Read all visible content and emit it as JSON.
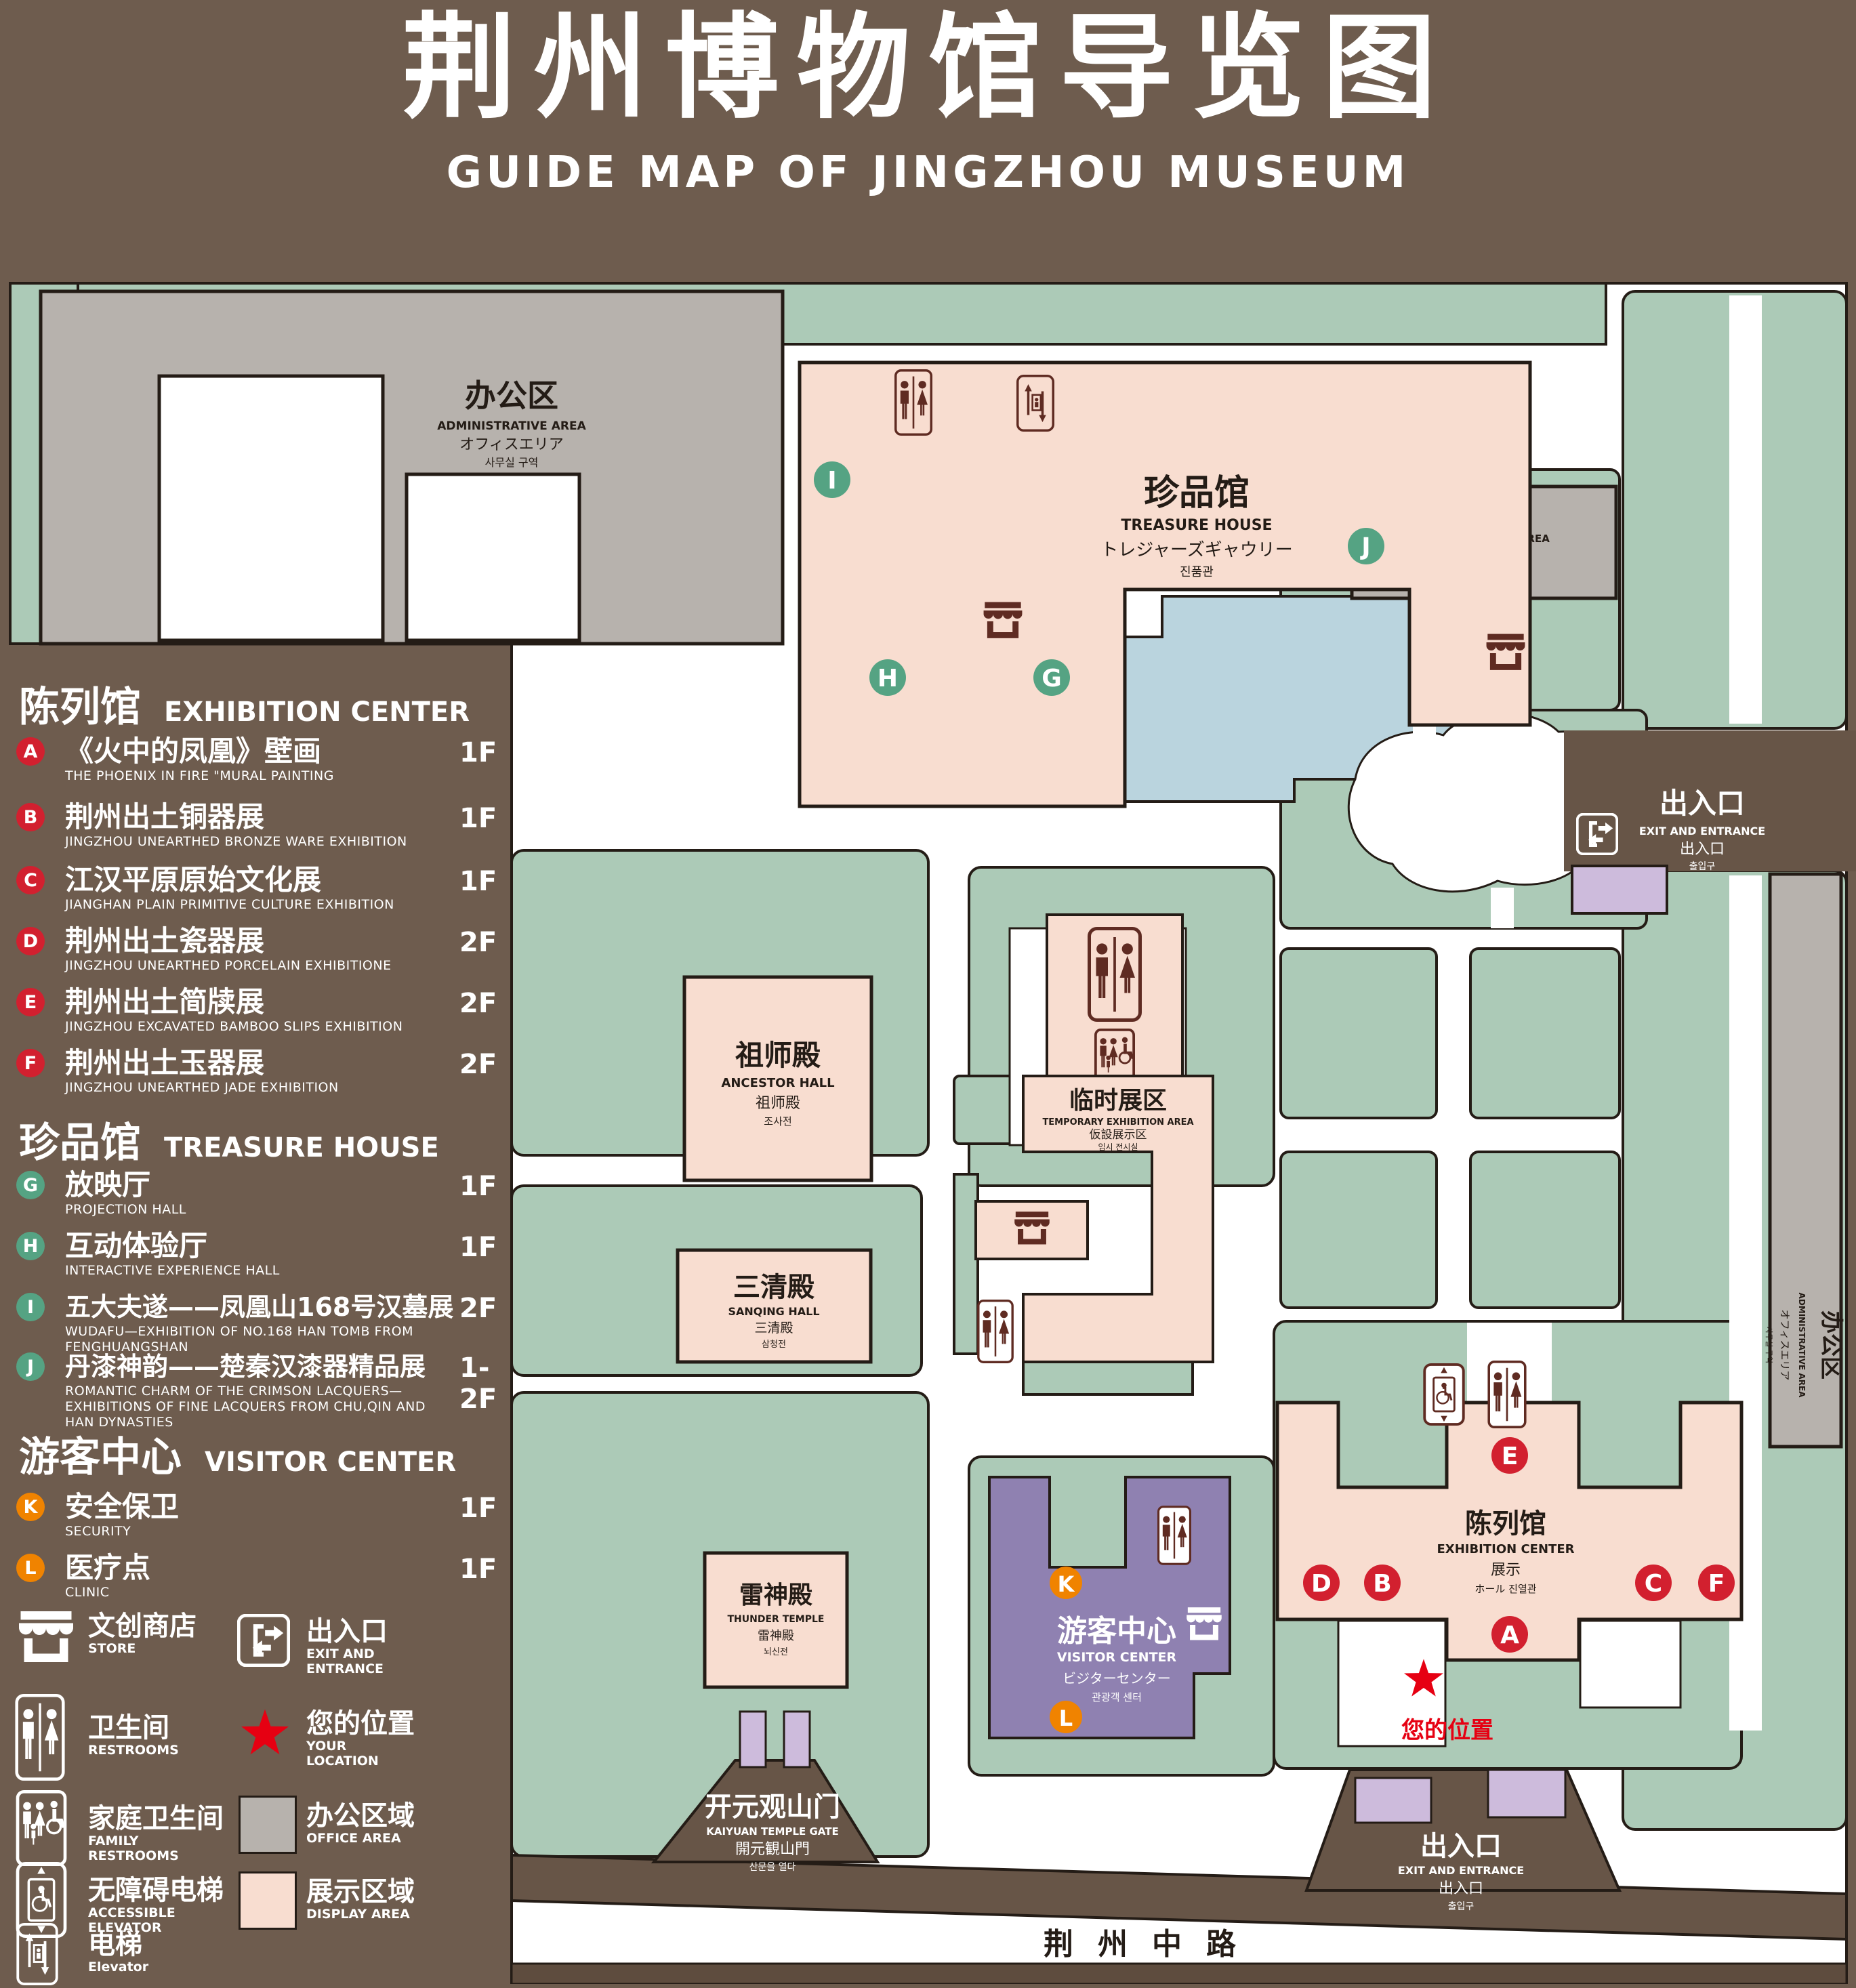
{
  "title": {
    "cn": "荆州博物馆导览图",
    "en": "GUIDE MAP OF JINGZHOU MUSEUM"
  },
  "colors": {
    "background": "#6e5c4e",
    "green_area": "#accab7",
    "display_area": "#f8ddd0",
    "office_area": "#b7b2ad",
    "pond": "#bad4de",
    "visitor_center": "#8f81b1",
    "gate_purple": "#cdbbdc",
    "badge_red": "#d2202f",
    "badge_green": "#55a383",
    "badge_orange": "#f08300",
    "star_red": "#e60012",
    "icon_maroon": "#5f2b22"
  },
  "legend": {
    "sections": [
      {
        "cn": "陈列馆",
        "en": "EXHIBITION CENTER",
        "items": [
          {
            "letter": "A",
            "cn": "《火中的凤凰》壁画",
            "en": "THE PHOENIX IN FIRE \"MURAL PAINTING",
            "floor": "1F"
          },
          {
            "letter": "B",
            "cn": "荆州出土铜器展",
            "en": "JINGZHOU UNEARTHED BRONZE WARE EXHIBITION",
            "floor": "1F"
          },
          {
            "letter": "C",
            "cn": "江汉平原原始文化展",
            "en": "JIANGHAN PLAIN PRIMITIVE CULTURE EXHIBITION",
            "floor": "1F"
          },
          {
            "letter": "D",
            "cn": "荆州出土瓷器展",
            "en": "JINGZHOU UNEARTHED PORCELAIN EXHIBITIONE",
            "floor": "2F"
          },
          {
            "letter": "E",
            "cn": "荆州出土简牍展",
            "en": "JINGZHOU EXCAVATED BAMBOO SLIPS EXHIBITION",
            "floor": "2F"
          },
          {
            "letter": "F",
            "cn": "荆州出土玉器展",
            "en": "JINGZHOU UNEARTHED JADE EXHIBITION",
            "floor": "2F"
          }
        ]
      },
      {
        "cn": "珍品馆",
        "en": "TREASURE HOUSE",
        "items": [
          {
            "letter": "G",
            "cn": "放映厅",
            "en": "PROJECTION HALL",
            "floor": "1F"
          },
          {
            "letter": "H",
            "cn": "互动体验厅",
            "en": "INTERACTIVE EXPERIENCE HALL",
            "floor": "1F"
          },
          {
            "letter": "I",
            "cn": "五大夫遂——凤凰山168号汉墓展",
            "en": "WUDAFU—EXHIBITION OF NO.168 HAN TOMB FROM FENGHUANGSHAN",
            "floor": "2F"
          },
          {
            "letter": "J",
            "cn": "丹漆神韵——楚秦汉漆器精品展",
            "en": "ROMANTIC CHARM OF THE CRIMSON LACQUERS—EXHIBITIONS OF FINE LACQUERS FROM CHU,QIN AND HAN DYNASTIES",
            "floor": "1-2F"
          }
        ]
      },
      {
        "cn": "游客中心",
        "en": "VISITOR CENTER",
        "items": [
          {
            "letter": "K",
            "cn": "安全保卫",
            "en": "SECURITY",
            "floor": "1F"
          },
          {
            "letter": "L",
            "cn": "医疗点",
            "en": "CLINIC",
            "floor": "1F"
          }
        ]
      }
    ],
    "symbols": {
      "store": {
        "cn": "文创商店",
        "en": "STORE"
      },
      "restrooms": {
        "cn": "卫生间",
        "en": "RESTROOMS"
      },
      "family_restrooms": {
        "cn": "家庭卫生间",
        "en": "FAMILY RESTROOMS"
      },
      "accessible_elevator": {
        "cn": "无障碍电梯",
        "en": "ACCESSIBLE ELEVATOR"
      },
      "elevator": {
        "cn": "电梯",
        "en": "Elevator"
      },
      "exit": {
        "cn": "出入口",
        "en": "EXIT AND ENTRANCE"
      },
      "your_location": {
        "cn": "您的位置",
        "en": "YOUR LOCATION"
      },
      "office_area": {
        "cn": "办公区域",
        "en": "OFFICE AREA"
      },
      "display_area": {
        "cn": "展示区域",
        "en": "DISPLAY AREA"
      }
    }
  },
  "map": {
    "treasure_house": {
      "cn": "珍品馆",
      "en": "TREASURE HOUSE",
      "l3": "トレジャーズギャウリー",
      "l4": "진품관"
    },
    "admin_area": {
      "cn": "办公区",
      "en": "ADMINISTRATIVE AREA",
      "l3": "オフィスエリア",
      "l4": "사무실 구역"
    },
    "ancestor_hall": {
      "cn": "祖师殿",
      "en": "ANCESTOR HALL",
      "l3": "祖师殿",
      "l4": "조사전"
    },
    "sanqing_hall": {
      "cn": "三清殿",
      "en": "SANQING HALL",
      "l3": "三清殿",
      "l4": "삼청전"
    },
    "thunder_temple": {
      "cn": "雷神殿",
      "en": "THUNDER TEMPLE",
      "l3": "雷神殿",
      "l4": "뇌신전"
    },
    "temporary_exhibition": {
      "cn": "临时展区",
      "en": "TEMPORARY EXHIBITION AREA",
      "l3": "仮設展示区",
      "l4": "임시 전시실"
    },
    "visitor_center": {
      "cn": "游客中心",
      "en": "VISITOR CENTER",
      "l3": "ビジターセンター",
      "l4": "관광객 센터"
    },
    "exhibition_center": {
      "cn": "陈列馆",
      "en": "EXHIBITION CENTER",
      "l3": "展示",
      "l4": "ホール 진열관"
    },
    "gate_south": {
      "cn": "开元观山门",
      "en": "KAIYUAN TEMPLE GATE",
      "l3": "開元観山門",
      "l4": "산문을 열다"
    },
    "exit_gate": {
      "cn": "出入口",
      "en": "EXIT AND ENTRANCE",
      "l3": "出入口",
      "l4": "출입구"
    },
    "road": "荆州中路",
    "your_location": "您的位置",
    "badges": {
      "red": [
        "A",
        "B",
        "C",
        "D",
        "E",
        "F"
      ],
      "green": [
        "G",
        "H",
        "I",
        "J"
      ],
      "orange": [
        "K",
        "L"
      ]
    }
  }
}
